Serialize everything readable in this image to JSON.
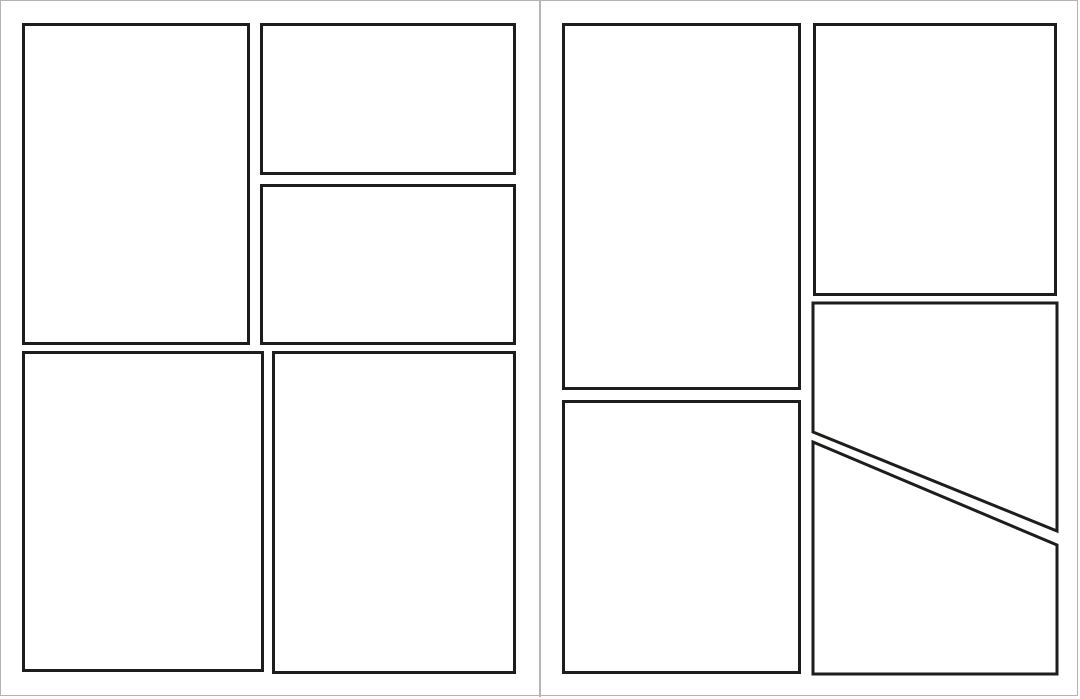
{
  "canvas": {
    "width": 1080,
    "height": 699,
    "background_color": "#ffffff",
    "frame_color": "#b2b2b2",
    "divider_color": "#b5b5b5",
    "divider_x": 539
  },
  "panel_style": {
    "border_color": "#1d1d1b",
    "border_width": 3,
    "fill": "#ffffff"
  },
  "pages": [
    {
      "name": "left-page",
      "panels": [
        {
          "id": "panel-1-tall-top-left",
          "shape": "rect",
          "x": 22,
          "y": 23,
          "w": 228,
          "h": 322
        },
        {
          "id": "panel-2-top-right-upper",
          "shape": "rect",
          "x": 260,
          "y": 23,
          "w": 256,
          "h": 152
        },
        {
          "id": "panel-3-top-right-lower",
          "shape": "rect",
          "x": 260,
          "y": 184,
          "w": 256,
          "h": 161
        },
        {
          "id": "panel-4-bottom-left",
          "shape": "rect",
          "x": 22,
          "y": 351,
          "w": 242,
          "h": 321
        },
        {
          "id": "panel-5-bottom-right",
          "shape": "rect",
          "x": 272,
          "y": 351,
          "w": 244,
          "h": 323
        }
      ]
    },
    {
      "name": "right-page",
      "panels": [
        {
          "id": "panel-6-tall-top-left",
          "shape": "rect",
          "x": 562,
          "y": 23,
          "w": 239,
          "h": 367
        },
        {
          "id": "panel-7-top-right",
          "shape": "rect",
          "x": 813,
          "y": 23,
          "w": 244,
          "h": 273
        },
        {
          "id": "panel-8-mid-right-diagonal",
          "shape": "polygon",
          "points": [
            [
              813,
              303
            ],
            [
              1057,
              303
            ],
            [
              1057,
              531
            ],
            [
              813,
              432
            ]
          ]
        },
        {
          "id": "panel-9-bottom-left",
          "shape": "rect",
          "x": 562,
          "y": 400,
          "w": 239,
          "h": 274
        },
        {
          "id": "panel-10-bottom-right-diagonal",
          "shape": "polygon",
          "points": [
            [
              813,
              442
            ],
            [
              1057,
              545
            ],
            [
              1057,
              674
            ],
            [
              813,
              674
            ]
          ]
        }
      ]
    }
  ]
}
